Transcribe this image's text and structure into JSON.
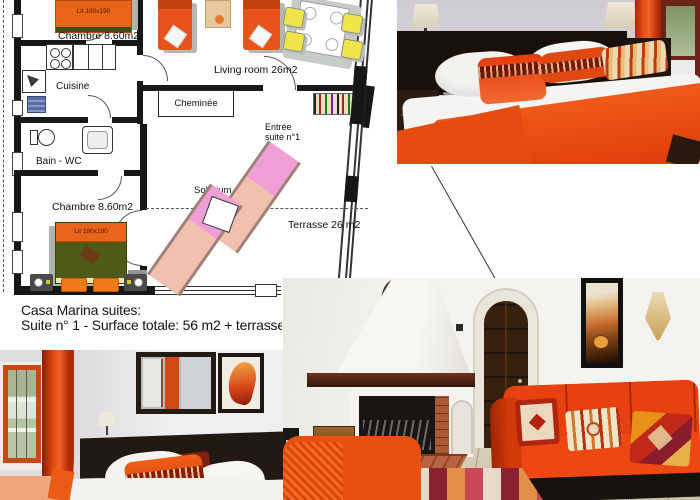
{
  "collage": {
    "caption": {
      "line1": "Casa Marina suites:",
      "line2": "Suite n° 1 - Surface totale: 56 m2 + terrasse 2"
    },
    "floor_plan": {
      "bedroom_top": {
        "bed": "Lit 180x190",
        "room": "Chambre 8.60m2"
      },
      "kitchen": "Cuisine",
      "bathroom": "Bain - WC",
      "bedroom_bottom": {
        "bed": "Lit 180x190",
        "room": "Chambre 8.60m2"
      },
      "living_room": "Living room 26m2",
      "fireplace": "Cheminée",
      "entrance_line1": "Entrée",
      "entrance_line2": "suite n°1",
      "solarium": "Solarium",
      "terrace": "Terrasse 26 m2"
    },
    "colors": {
      "plan_orange": "#e8641a",
      "chair_yellow": "#f0e44a",
      "lounger_pink": "#ef9ed6",
      "lounger_salmon": "#f2c0ae",
      "bedspread_green": "#4f5a17",
      "sofa_red": "#e8400e",
      "wall_black": "#171717"
    }
  }
}
